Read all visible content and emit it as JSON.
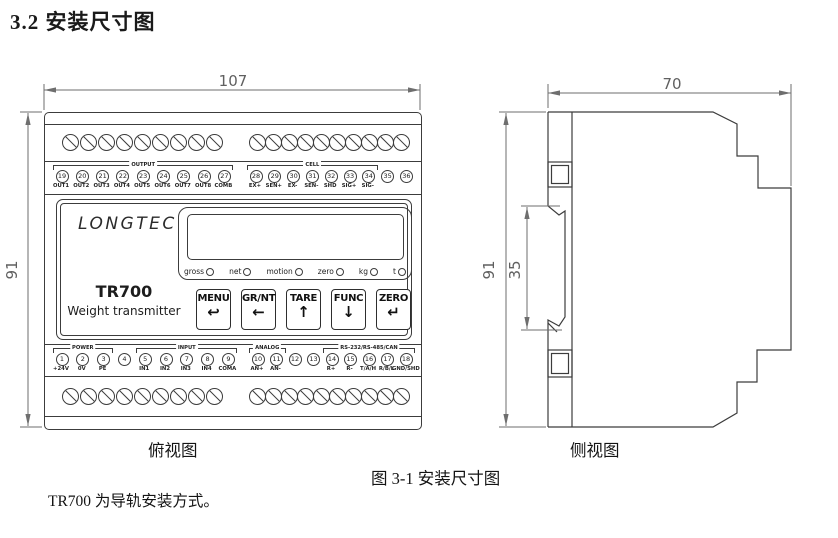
{
  "page": {
    "section_title": "3.2 安装尺寸图",
    "figure_caption": "图 3-1 安装尺寸图",
    "note": "TR700 为导轨安装方式。",
    "front_view_caption": "俯视图",
    "side_view_caption": "侧视图"
  },
  "dimensions": {
    "front_width_mm": "107",
    "front_height_mm": "91",
    "side_width_mm": "70",
    "side_height_mm": "91",
    "rail_height_mm": "35"
  },
  "device": {
    "brand": "LONGTEC",
    "model": "TR700",
    "subtitle": "Weight transmitter",
    "indicators": [
      "gross",
      "net",
      "motion",
      "zero",
      "kg",
      "t"
    ],
    "buttons": [
      {
        "label": "MENU",
        "glyph": "↩",
        "icon": "back-arrow-icon"
      },
      {
        "label": "GR/NT",
        "glyph": "←",
        "icon": "left-arrow-icon"
      },
      {
        "label": "TARE",
        "glyph": "↑",
        "icon": "up-arrow-icon"
      },
      {
        "label": "FUNC",
        "glyph": "↓",
        "icon": "down-arrow-icon"
      },
      {
        "label": "ZERO",
        "glyph": "↵",
        "icon": "enter-arrow-icon"
      }
    ],
    "terminal_groups": {
      "top_left": {
        "brackets": [
          {
            "label": "OUTPUT",
            "from": 0,
            "to": 8
          }
        ],
        "items": [
          {
            "num": "19",
            "label": "OUT1"
          },
          {
            "num": "20",
            "label": "OUT2"
          },
          {
            "num": "21",
            "label": "OUT3"
          },
          {
            "num": "22",
            "label": "OUT4"
          },
          {
            "num": "23",
            "label": "OUT5"
          },
          {
            "num": "24",
            "label": "OUT6"
          },
          {
            "num": "25",
            "label": "OUT7"
          },
          {
            "num": "26",
            "label": "OUT8"
          },
          {
            "num": "27",
            "label": "COMB"
          }
        ]
      },
      "top_right": {
        "brackets": [
          {
            "label": "CELL",
            "from": 0,
            "to": 6
          }
        ],
        "items": [
          {
            "num": "28",
            "label": "EX+"
          },
          {
            "num": "29",
            "label": "SEN+"
          },
          {
            "num": "30",
            "label": "EX-"
          },
          {
            "num": "31",
            "label": "SEN-"
          },
          {
            "num": "32",
            "label": "SHD"
          },
          {
            "num": "33",
            "label": "SIG+"
          },
          {
            "num": "34",
            "label": "SIG-"
          },
          {
            "num": "35",
            "label": ""
          },
          {
            "num": "36",
            "label": ""
          }
        ]
      },
      "bottom_left": {
        "brackets": [
          {
            "label": "POWER",
            "from": 0,
            "to": 2
          },
          {
            "label": "INPUT",
            "from": 4,
            "to": 8
          }
        ],
        "items": [
          {
            "num": "1",
            "label": "+24V"
          },
          {
            "num": "2",
            "label": "0V"
          },
          {
            "num": "3",
            "label": "PE"
          },
          {
            "num": "4",
            "label": ""
          },
          {
            "num": "5",
            "label": "IN1"
          },
          {
            "num": "6",
            "label": "IN2"
          },
          {
            "num": "7",
            "label": "IN3"
          },
          {
            "num": "8",
            "label": "IN4"
          },
          {
            "num": "9",
            "label": "COMA"
          }
        ]
      },
      "bottom_right": {
        "brackets": [
          {
            "label": "ANALOG",
            "from": 0,
            "to": 1
          },
          {
            "label": "RS-232/RS-485/CAN",
            "from": 4,
            "to": 8
          }
        ],
        "items": [
          {
            "num": "10",
            "label": "AN+"
          },
          {
            "num": "11",
            "label": "AN-"
          },
          {
            "num": "12",
            "label": ""
          },
          {
            "num": "13",
            "label": ""
          },
          {
            "num": "14",
            "label": "R+"
          },
          {
            "num": "15",
            "label": "R-"
          },
          {
            "num": "16",
            "label": "T/A/H"
          },
          {
            "num": "17",
            "label": "R/B/L"
          },
          {
            "num": "18",
            "label": "GND/SHD"
          }
        ]
      }
    }
  },
  "colors": {
    "drawing_line": "#3c3c3c",
    "dimension_line": "#6e6e6e",
    "text": "#1a1a1a"
  }
}
